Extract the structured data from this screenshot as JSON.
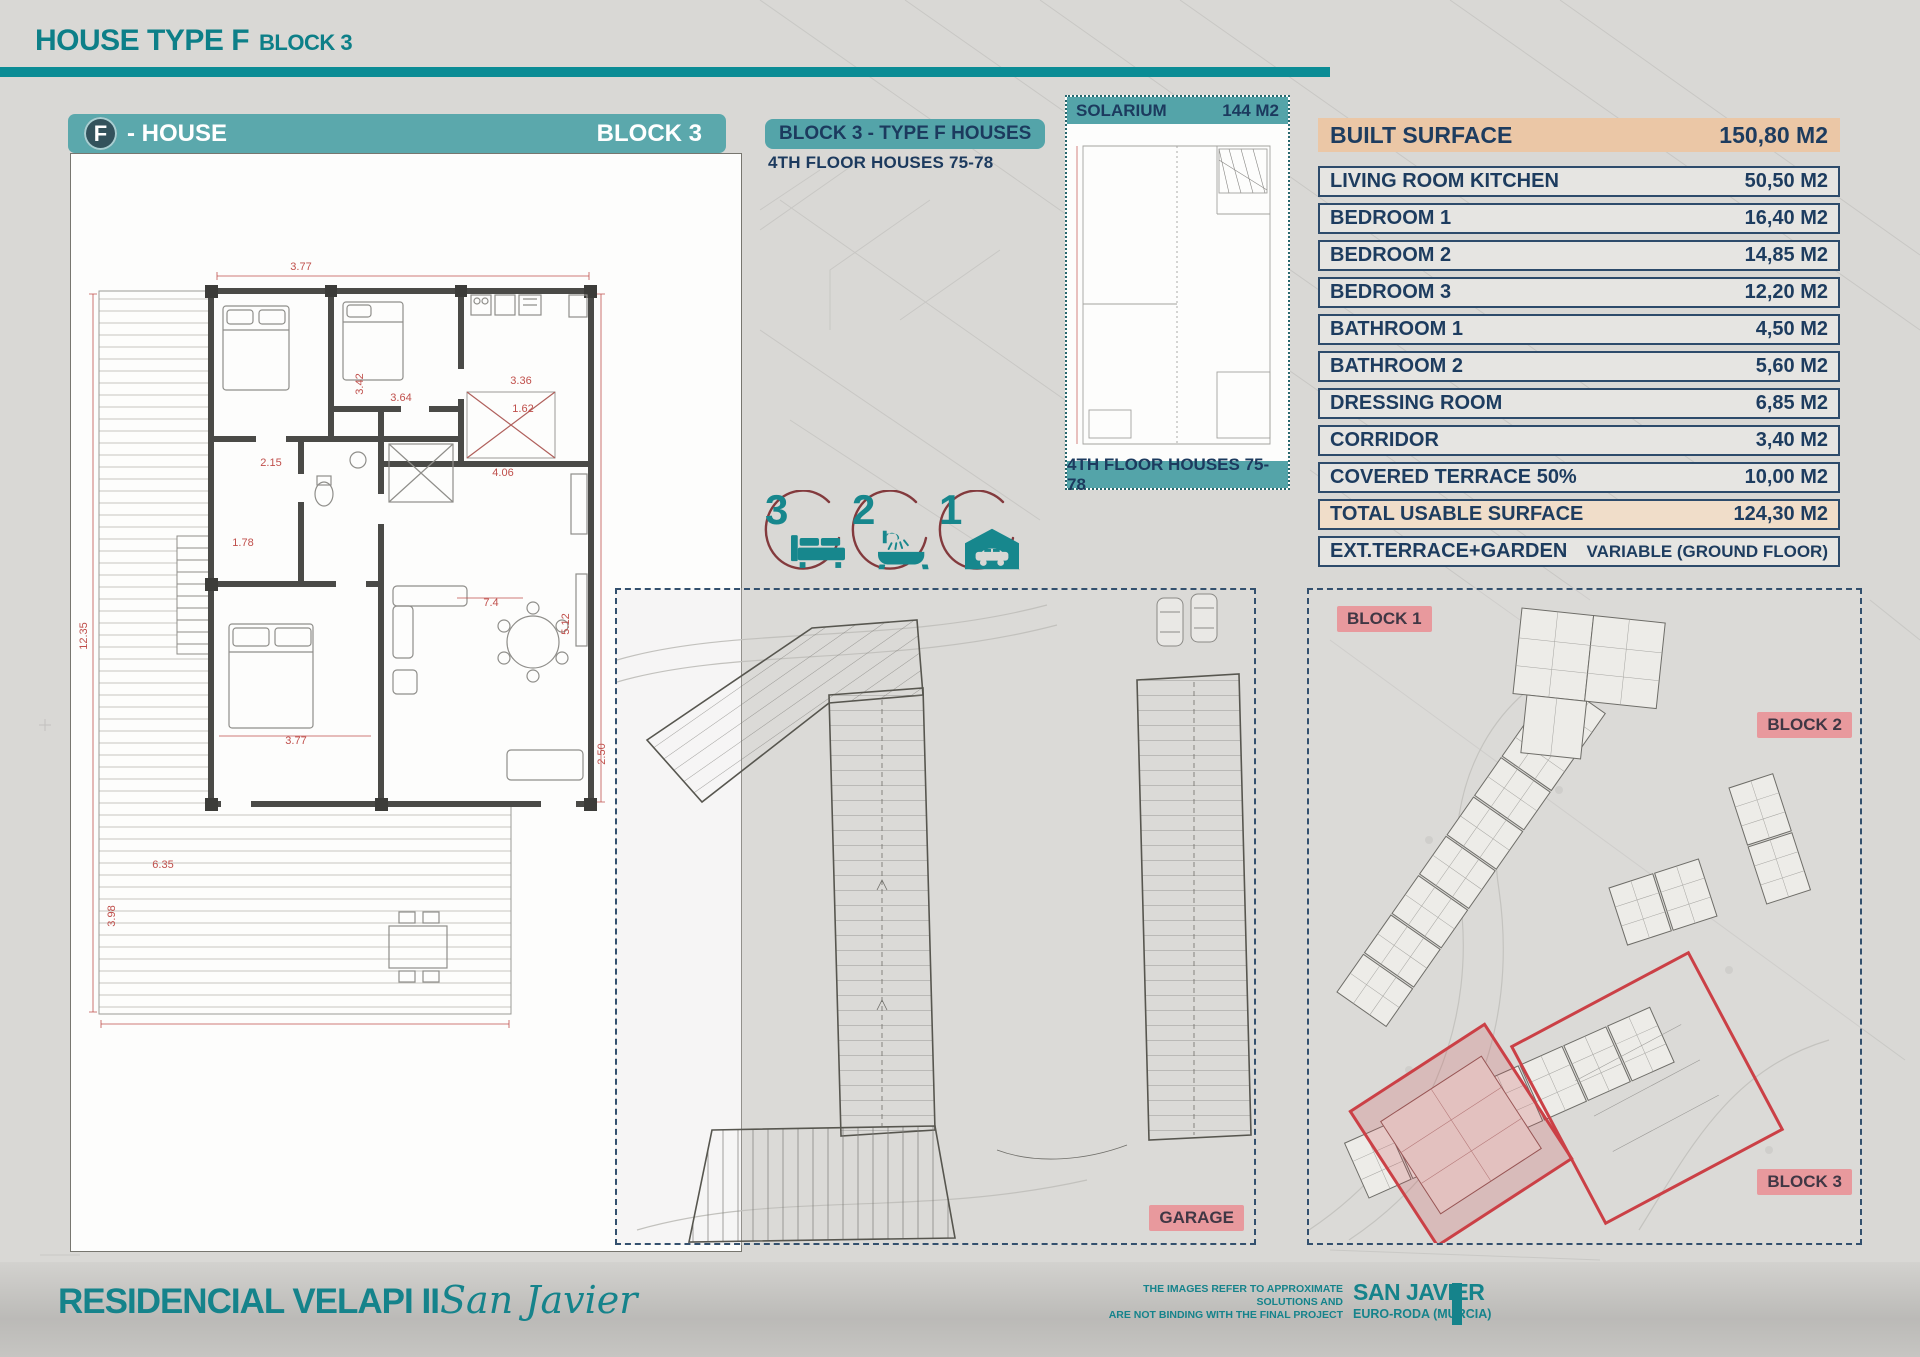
{
  "header": {
    "title": "HOUSE TYPE F",
    "subtitle": "BLOCK 3"
  },
  "banner": {
    "letter": "F",
    "label": "- HOUSE",
    "block": "BLOCK 3"
  },
  "plan_label": {
    "pill": "BLOCK 3 - TYPE F HOUSES",
    "sub": "4TH FLOOR HOUSES 75-78"
  },
  "features": [
    {
      "count": "3",
      "icon": "bed-icon"
    },
    {
      "count": "2",
      "icon": "bath-icon"
    },
    {
      "count": "1",
      "icon": "garage-icon"
    }
  ],
  "solarium": {
    "title": "SOLARIUM",
    "area": "144 M2",
    "caption": "4TH FLOOR HOUSES 75-78"
  },
  "surface_table": {
    "header": {
      "label": "BUILT SURFACE",
      "value": "150,80 M2"
    },
    "rows": [
      {
        "label": "LIVING ROOM KITCHEN",
        "value": "50,50 M2"
      },
      {
        "label": "BEDROOM 1",
        "value": "16,40 M2"
      },
      {
        "label": "BEDROOM 2",
        "value": "14,85 M2"
      },
      {
        "label": "BEDROOM 3",
        "value": "12,20 M2"
      },
      {
        "label": "BATHROOM 1",
        "value": "4,50 M2"
      },
      {
        "label": "BATHROOM 2",
        "value": "5,60 M2"
      },
      {
        "label": "DRESSING ROOM",
        "value": "6,85 M2"
      },
      {
        "label": "CORRIDOR",
        "value": "3,40 M2"
      },
      {
        "label": "COVERED TERRACE 50%",
        "value": "10,00 M2"
      },
      {
        "label": "TOTAL USABLE SURFACE",
        "value": "124,30 M2",
        "highlight": true
      },
      {
        "label": "EXT.TERRACE+GARDEN",
        "value": "VARIABLE (GROUND FLOOR)",
        "wide_value": true
      }
    ]
  },
  "site_plan": {
    "garage_label": "GARAGE",
    "block1_label": "BLOCK 1",
    "block2_label": "BLOCK 2",
    "block3_label": "BLOCK 3"
  },
  "floorplan": {
    "dimensions": [
      {
        "t": "12.35",
        "x": 16,
        "y": 482,
        "r": -90
      },
      {
        "t": "3.77",
        "x": 230,
        "y": 116,
        "r": 0
      },
      {
        "t": "3.42",
        "x": 292,
        "y": 230,
        "r": -90
      },
      {
        "t": "3.64",
        "x": 330,
        "y": 247,
        "r": 0
      },
      {
        "t": "3.36",
        "x": 450,
        "y": 230,
        "r": 0
      },
      {
        "t": "1.62",
        "x": 452,
        "y": 258,
        "r": 0
      },
      {
        "t": "4.06",
        "x": 432,
        "y": 322,
        "r": 0
      },
      {
        "t": "5.12",
        "x": 498,
        "y": 470,
        "r": -90
      },
      {
        "t": "7.4",
        "x": 420,
        "y": 452,
        "r": 0
      },
      {
        "t": "2.15",
        "x": 200,
        "y": 312,
        "r": 0
      },
      {
        "t": "1.78",
        "x": 172,
        "y": 392,
        "r": 0
      },
      {
        "t": "3.77",
        "x": 225,
        "y": 590,
        "r": 0
      },
      {
        "t": "6.35",
        "x": 92,
        "y": 714,
        "r": 0
      },
      {
        "t": "3.98",
        "x": 44,
        "y": 762,
        "r": -90
      },
      {
        "t": "2.50",
        "x": 534,
        "y": 600,
        "r": -90
      }
    ]
  },
  "footer": {
    "brand": "RESIDENCIAL VELAPI II",
    "brand_script": "San Javier",
    "disclaimer_line1": "THE IMAGES REFER TO APPROXIMATE SOLUTIONS AND",
    "disclaimer_line2": "ARE NOT BINDING WITH THE FINAL PROJECT",
    "location": "SAN JAVIER",
    "sublocation": "EURO-RODA (MURCIA)"
  },
  "colors": {
    "teal": "#0d7f88",
    "teal_band": "#54a4a9",
    "navy": "#1d3c5f",
    "tan": "#ebc7a6",
    "pink_badge": "#e8999d",
    "red_highlight": "#cb4046"
  }
}
